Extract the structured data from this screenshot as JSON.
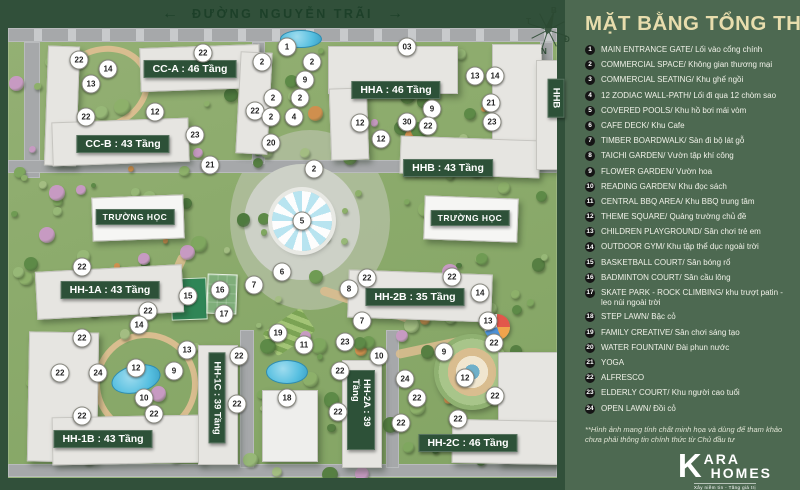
{
  "panel": {
    "title": "MẶT BẰNG TỔNG THỂ",
    "legend": [
      {
        "num": "1",
        "text": "MAIN ENTRANCE GATE/ Lối vào cổng chính"
      },
      {
        "num": "2",
        "text": "COMMERCIAL SPACE/ Không gian thương mại"
      },
      {
        "num": "3",
        "text": "COMMERCIAL SEATING/ Khu ghế ngồi"
      },
      {
        "num": "4",
        "text": "12 ZODIAC WALL-PATH/ Lối đi qua 12 chòm sao"
      },
      {
        "num": "5",
        "text": "COVERED POOLS/ Khu hồ bơi mái vòm"
      },
      {
        "num": "6",
        "text": "CAFE DECK/ Khu Cafe"
      },
      {
        "num": "7",
        "text": "TIMBER BOARDWALK/ Sàn đi bộ lát gỗ"
      },
      {
        "num": "8",
        "text": "TAICHI GARDEN/ Vườn tập khí công"
      },
      {
        "num": "9",
        "text": "FLOWER GARDEN/ Vườn hoa"
      },
      {
        "num": "10",
        "text": "READING GARDEN/ Khu đọc sách"
      },
      {
        "num": "11",
        "text": "CENTRAL BBQ AREA/ Khu BBQ trung tâm"
      },
      {
        "num": "12",
        "text": "THEME SQUARE/ Quảng trường chủ đề"
      },
      {
        "num": "13",
        "text": "CHILDREN PLAYGROUND/ Sân chơi trẻ em"
      },
      {
        "num": "14",
        "text": "OUTDOOR GYM/ Khu tập thể dục ngoài trời"
      },
      {
        "num": "15",
        "text": "BASKETBALL COURT/ Sân bóng rổ"
      },
      {
        "num": "16",
        "text": "BADMINTON COURT/ Sân cầu lông"
      },
      {
        "num": "17",
        "text": "SKATE PARK - ROCK CLIMBING/ khu trượt patin - leo núi ngoài trời"
      },
      {
        "num": "18",
        "text": "STEP LAWN/ Bậc cỏ"
      },
      {
        "num": "19",
        "text": "FAMILY CREATIVE/ Sân chơi sáng tạo"
      },
      {
        "num": "20",
        "text": "WATER FOUNTAIN/ Đài phun nước"
      },
      {
        "num": "21",
        "text": "YOGA"
      },
      {
        "num": "22",
        "text": "ALFRESCO"
      },
      {
        "num": "23",
        "text": "ELDERLY COURT/ Khu người cao tuổi"
      },
      {
        "num": "24",
        "text": "OPEN LAWN/ Đồi cỏ"
      }
    ],
    "disclaimer": "**Hình ảnh mang tính chất minh họa và dùng để tham khảo chưa phải thông tin chính thức từ Chủ đầu tư",
    "logo": {
      "k": "K",
      "line1": "ARA",
      "line2": "HOMES",
      "tagline": "Xây niềm tin - Tăng giá trị"
    }
  },
  "map": {
    "road_name": "ĐƯỜNG NGUYỄN TRÃI",
    "compass": {
      "top": "B",
      "left": "T",
      "right": "Đ",
      "bottom": "N"
    },
    "building_labels": [
      {
        "text": "CC-A : 46 Tầng",
        "x": 190,
        "y": 69,
        "style": "big"
      },
      {
        "text": "CC-B : 43 Tầng",
        "x": 123,
        "y": 144,
        "style": "big"
      },
      {
        "text": "HHA : 46 Tầng",
        "x": 396,
        "y": 90,
        "style": "big"
      },
      {
        "text": "HHB : 43 Tầng",
        "x": 448,
        "y": 168,
        "style": "big"
      },
      {
        "text": "TRƯỜNG HỌC",
        "x": 135,
        "y": 217,
        "style": "small"
      },
      {
        "text": "TRƯỜNG HỌC",
        "x": 470,
        "y": 218,
        "style": "small"
      },
      {
        "text": "HH-1A : 43 Tầng",
        "x": 110,
        "y": 290,
        "style": "big"
      },
      {
        "text": "HH-2B : 35 Tầng",
        "x": 415,
        "y": 297,
        "style": "big"
      },
      {
        "text": "HH-1B : 43 Tầng",
        "x": 103,
        "y": 439,
        "style": "big"
      },
      {
        "text": "HH-2C : 46 Tầng",
        "x": 468,
        "y": 443,
        "style": "big"
      },
      {
        "text": "HH-1C : 39 Tầng",
        "x": 217,
        "y": 398,
        "style": "vert"
      },
      {
        "text": "HH-2A : 39 Tầng",
        "x": 361,
        "y": 410,
        "style": "vert"
      },
      {
        "text": "HHB",
        "x": 556,
        "y": 98,
        "style": "vert"
      }
    ],
    "markers": [
      {
        "n": "22",
        "x": 79,
        "y": 60
      },
      {
        "n": "14",
        "x": 108,
        "y": 69
      },
      {
        "n": "13",
        "x": 91,
        "y": 84
      },
      {
        "n": "22",
        "x": 86,
        "y": 117
      },
      {
        "n": "12",
        "x": 155,
        "y": 112
      },
      {
        "n": "23",
        "x": 195,
        "y": 135
      },
      {
        "n": "21",
        "x": 210,
        "y": 165
      },
      {
        "n": "22",
        "x": 203,
        "y": 53
      },
      {
        "n": "2",
        "x": 262,
        "y": 62
      },
      {
        "n": "1",
        "x": 287,
        "y": 47
      },
      {
        "n": "2",
        "x": 273,
        "y": 98
      },
      {
        "n": "22",
        "x": 255,
        "y": 111
      },
      {
        "n": "2",
        "x": 271,
        "y": 117
      },
      {
        "n": "20",
        "x": 271,
        "y": 143
      },
      {
        "n": "2",
        "x": 312,
        "y": 62
      },
      {
        "n": "9",
        "x": 305,
        "y": 80
      },
      {
        "n": "2",
        "x": 300,
        "y": 98
      },
      {
        "n": "4",
        "x": 294,
        "y": 117
      },
      {
        "n": "03",
        "x": 407,
        "y": 47
      },
      {
        "n": "13",
        "x": 475,
        "y": 76
      },
      {
        "n": "14",
        "x": 495,
        "y": 76
      },
      {
        "n": "21",
        "x": 491,
        "y": 103
      },
      {
        "n": "23",
        "x": 492,
        "y": 122
      },
      {
        "n": "9",
        "x": 432,
        "y": 109
      },
      {
        "n": "30",
        "x": 407,
        "y": 122
      },
      {
        "n": "22",
        "x": 428,
        "y": 126
      },
      {
        "n": "12",
        "x": 360,
        "y": 123
      },
      {
        "n": "12",
        "x": 381,
        "y": 139
      },
      {
        "n": "2",
        "x": 314,
        "y": 169
      },
      {
        "n": "5",
        "x": 302,
        "y": 221
      },
      {
        "n": "6",
        "x": 282,
        "y": 272
      },
      {
        "n": "8",
        "x": 349,
        "y": 289
      },
      {
        "n": "22",
        "x": 367,
        "y": 278
      },
      {
        "n": "22",
        "x": 452,
        "y": 277
      },
      {
        "n": "14",
        "x": 480,
        "y": 293
      },
      {
        "n": "13",
        "x": 488,
        "y": 321
      },
      {
        "n": "7",
        "x": 362,
        "y": 321
      },
      {
        "n": "22",
        "x": 82,
        "y": 267
      },
      {
        "n": "15",
        "x": 188,
        "y": 296
      },
      {
        "n": "16",
        "x": 220,
        "y": 290
      },
      {
        "n": "7",
        "x": 254,
        "y": 285
      },
      {
        "n": "17",
        "x": 224,
        "y": 314
      },
      {
        "n": "22",
        "x": 148,
        "y": 311
      },
      {
        "n": "14",
        "x": 139,
        "y": 325
      },
      {
        "n": "19",
        "x": 278,
        "y": 333
      },
      {
        "n": "11",
        "x": 304,
        "y": 345
      },
      {
        "n": "23",
        "x": 345,
        "y": 342
      },
      {
        "n": "10",
        "x": 379,
        "y": 356
      },
      {
        "n": "22",
        "x": 340,
        "y": 371
      },
      {
        "n": "9",
        "x": 444,
        "y": 352
      },
      {
        "n": "22",
        "x": 494,
        "y": 343
      },
      {
        "n": "12",
        "x": 465,
        "y": 378
      },
      {
        "n": "24",
        "x": 405,
        "y": 379
      },
      {
        "n": "22",
        "x": 417,
        "y": 398
      },
      {
        "n": "22",
        "x": 495,
        "y": 396
      },
      {
        "n": "18",
        "x": 287,
        "y": 398
      },
      {
        "n": "22",
        "x": 338,
        "y": 412
      },
      {
        "n": "22",
        "x": 458,
        "y": 419
      },
      {
        "n": "22",
        "x": 401,
        "y": 423
      },
      {
        "n": "22",
        "x": 82,
        "y": 338
      },
      {
        "n": "13",
        "x": 187,
        "y": 350
      },
      {
        "n": "22",
        "x": 60,
        "y": 373
      },
      {
        "n": "24",
        "x": 98,
        "y": 373
      },
      {
        "n": "12",
        "x": 136,
        "y": 368
      },
      {
        "n": "9",
        "x": 174,
        "y": 371
      },
      {
        "n": "22",
        "x": 239,
        "y": 356
      },
      {
        "n": "10",
        "x": 144,
        "y": 398
      },
      {
        "n": "22",
        "x": 154,
        "y": 414
      },
      {
        "n": "22",
        "x": 237,
        "y": 404
      },
      {
        "n": "22",
        "x": 82,
        "y": 416
      }
    ]
  },
  "colors": {
    "frame": "#31503a",
    "panel": "#4d6951",
    "label_bg": "#2d5138",
    "title_gold": "#e8ddad",
    "pool_blue": "#56bfe0"
  }
}
